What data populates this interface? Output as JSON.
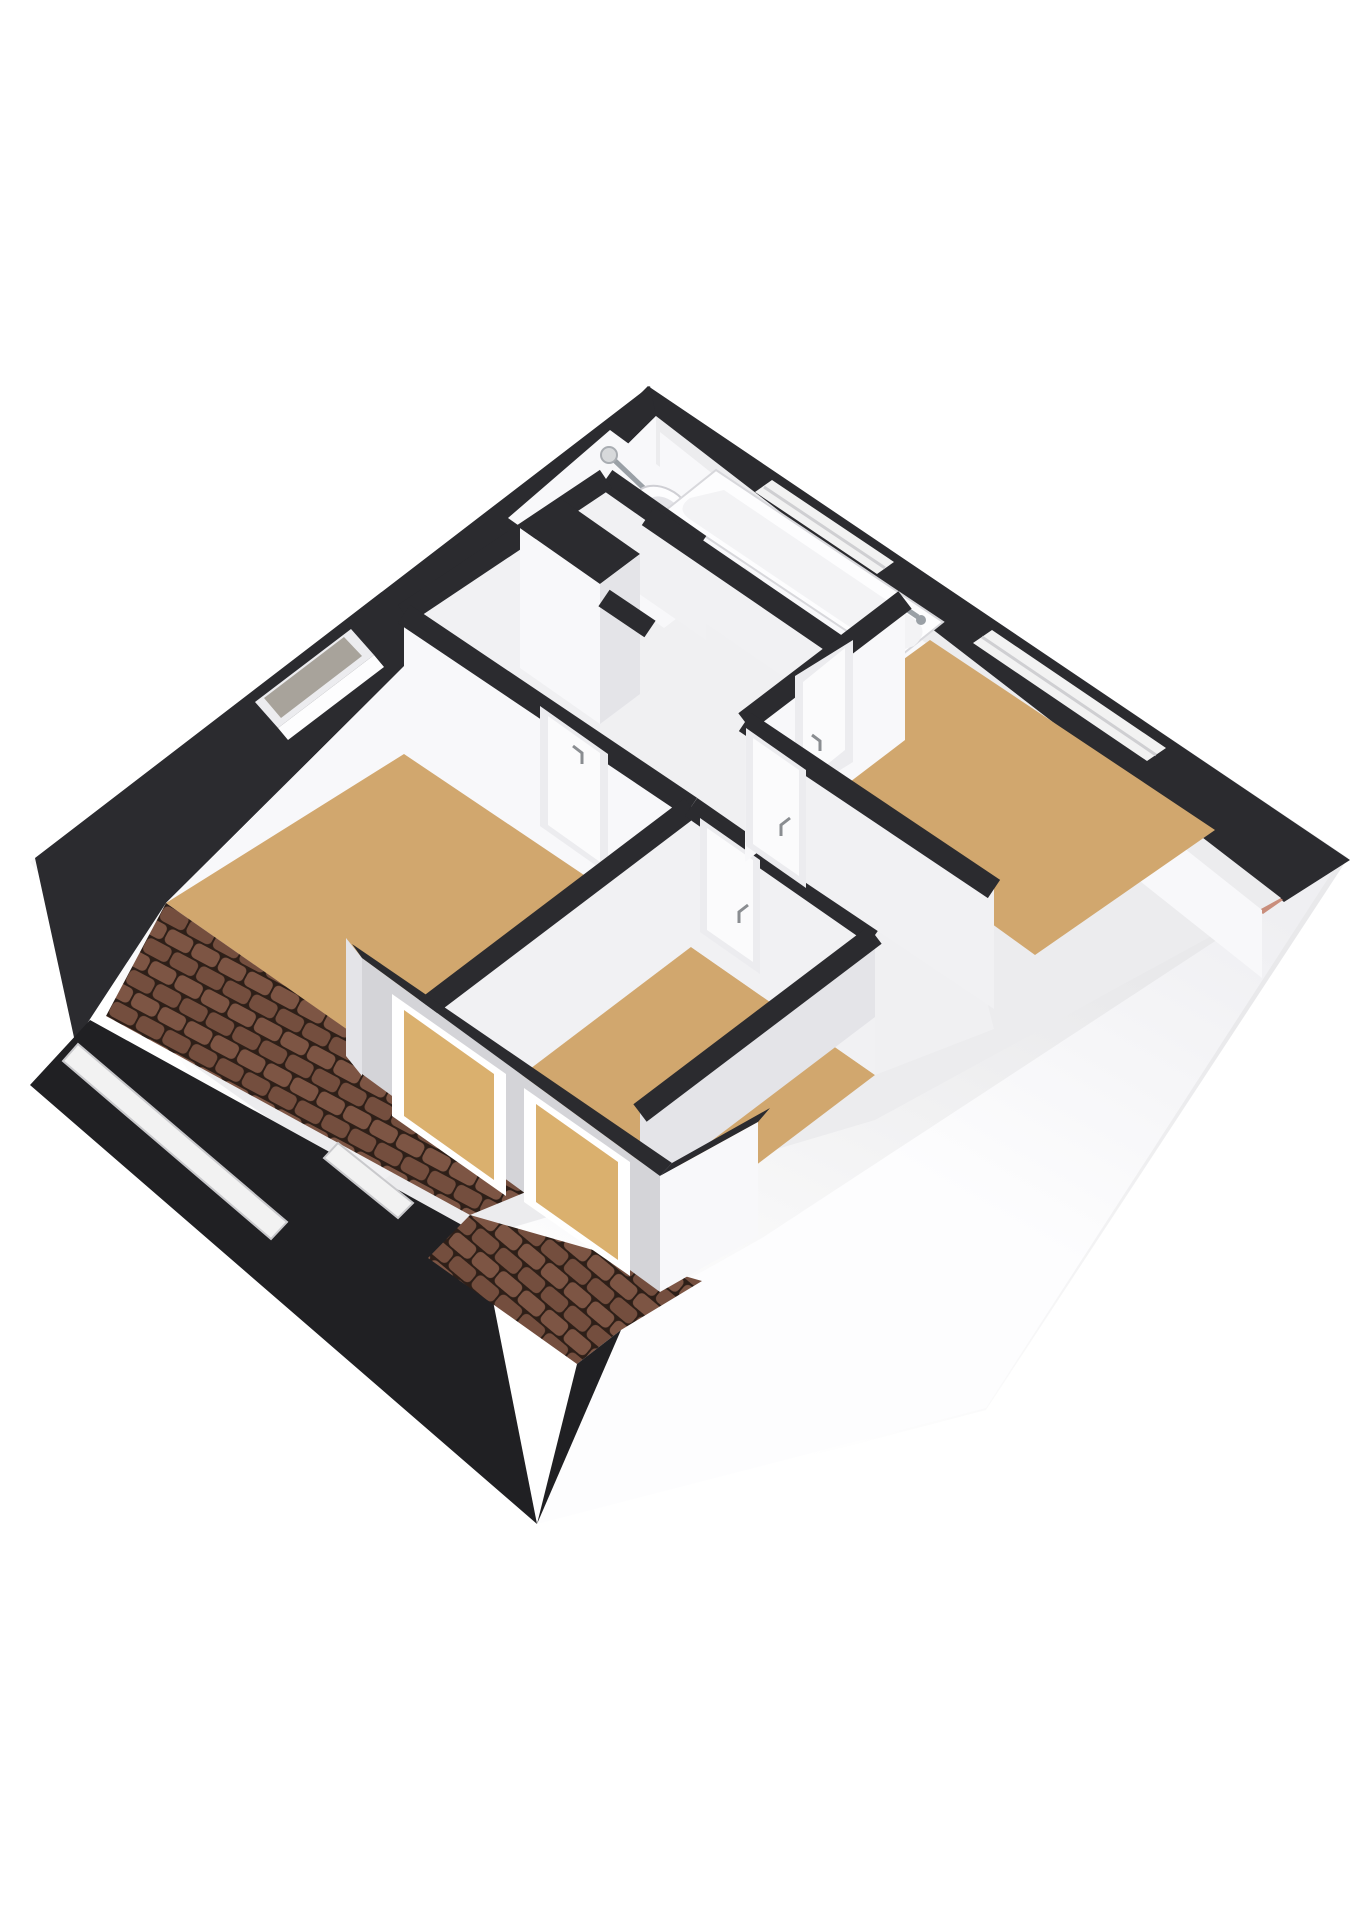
{
  "scene": {
    "type": "3d-floor-plan-render",
    "view": "axonometric-top-down",
    "storey": "attic-floor",
    "objects": [
      "left-bedroom",
      "front-bedroom",
      "right-bedroom",
      "landing",
      "bathroom-washbasin",
      "bathtub-niche",
      "stairwell",
      "dormer-two-windows",
      "tiled-roof",
      "roof-windows",
      "facade-wall",
      "ground-shadow-plate"
    ],
    "fixtures": [
      "bathtub",
      "washbasin",
      "staircase",
      "door",
      "window",
      "door-handle",
      "faucet"
    ]
  },
  "colors": {
    "wall-dark": "#2b2b2f",
    "wall-darker": "#202023",
    "wall-white": "#f8f8fa",
    "wall-light": "#f1f1f3",
    "wall-shade": "#e4e4e8",
    "wall-deep-shade": "#d4d4d8",
    "interior-base": "#ececee",
    "floor-tan": "#d1a76e",
    "floor-light": "#f0f0f2",
    "tile-base": "#744e3e",
    "tile-light": "#7d5544",
    "tile-dark": "#2e1f18",
    "salmon": "#c98e7c",
    "glass-gray": "#a8a39b",
    "glass-tan": "#dab06e",
    "fixture-white": "#fdfdfe",
    "fixture-inner": "#f3f3f5",
    "metal": "#9aa0a6",
    "frame-white": "#ececef",
    "door-white": "#fbfbfc",
    "skylight-white": "#f2f2f2",
    "ground-near": "#e8e8ea",
    "ground-far": "#ffffff",
    "knee-strip": "#f2f2f3"
  }
}
